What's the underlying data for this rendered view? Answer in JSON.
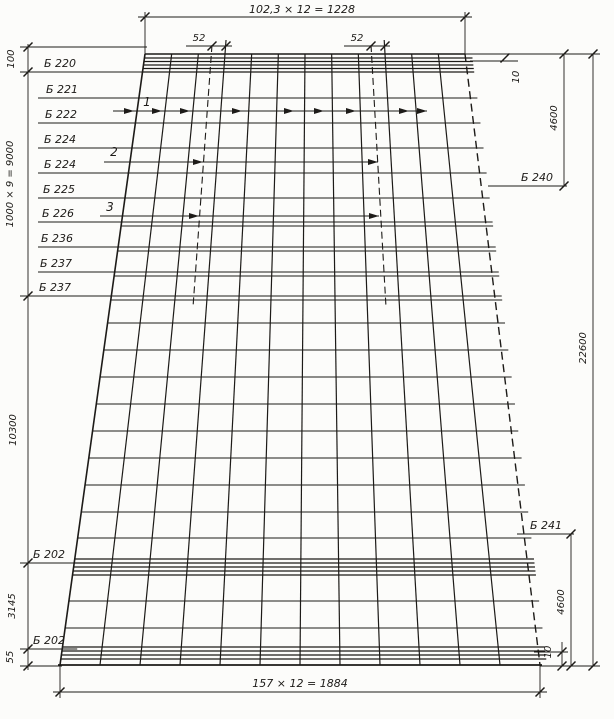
{
  "drawing": {
    "colors": {
      "ink": "#1d1b18",
      "paper": "#fcfcfa"
    },
    "trapezoid": {
      "top_y": 54,
      "bottom_y": 665,
      "top_x1": 145,
      "top_x2": 465,
      "bottom_x1": 60,
      "bottom_x2": 540
    },
    "grid": {
      "vertical_count": 13,
      "top_dx": 26.6667,
      "bot_dx": 40,
      "tall_tops": [
        3,
        9
      ],
      "tall_top_y": 40,
      "rows_single": [
        98,
        123,
        148,
        173,
        198,
        323,
        350,
        377,
        404,
        431,
        458,
        485,
        512,
        538,
        601,
        628
      ],
      "rows_double": [
        222,
        247,
        272,
        296
      ],
      "double_gap": 4,
      "bands": [
        [
          58,
          61.5,
          65,
          68.5,
          72
        ],
        [
          559,
          563,
          567,
          571,
          575
        ],
        [
          647,
          651,
          655,
          659
        ]
      ],
      "right_overhang": 7
    },
    "dashed_lines": [
      {
        "x1": 212,
        "y1": 45,
        "x2": 193,
        "y2": 307
      },
      {
        "x1": 371,
        "y1": 45,
        "x2": 386,
        "y2": 307
      }
    ],
    "arrow_callouts": [
      {
        "label": "1",
        "lx": 147,
        "ly": 106,
        "y": 111,
        "x1": 113,
        "x2": 427,
        "tips": [
          134,
          162,
          190,
          242,
          294,
          324,
          356,
          409,
          427
        ]
      },
      {
        "label": "2",
        "lx": 114,
        "ly": 156,
        "y": 162,
        "x1": 104,
        "x2": 378,
        "tips": [
          203,
          378
        ]
      },
      {
        "label": "3",
        "lx": 110,
        "ly": 211,
        "y": 216,
        "x1": 100,
        "x2": 379,
        "tips": [
          199,
          379
        ]
      }
    ],
    "beam_labels_left": [
      {
        "text": "Б 220",
        "tx": 44,
        "ty": 67,
        "leader_y": 72
      },
      {
        "text": "Б 221",
        "tx": 46,
        "ty": 93,
        "leader_y": 98
      },
      {
        "text": "Б 222",
        "tx": 45,
        "ty": 118,
        "leader_y": 123
      },
      {
        "text": "Б 224",
        "tx": 44,
        "ty": 143,
        "leader_y": 148
      },
      {
        "text": "Б 224",
        "tx": 44,
        "ty": 168,
        "leader_y": 173
      },
      {
        "text": "Б 225",
        "tx": 43,
        "ty": 193,
        "leader_y": 198
      },
      {
        "text": "Б 226",
        "tx": 42,
        "ty": 217,
        "leader_y": 222
      },
      {
        "text": "Б 236",
        "tx": 41,
        "ty": 242,
        "leader_y": 247
      },
      {
        "text": "Б 237",
        "tx": 40,
        "ty": 267,
        "leader_y": 272
      },
      {
        "text": "Б 237",
        "tx": 39,
        "ty": 291,
        "leader_y": 296
      },
      {
        "text": "Б 202",
        "tx": 33,
        "ty": 558,
        "leader_y": 563
      },
      {
        "text": "Б 202",
        "tx": 33,
        "ty": 644,
        "leader_y": 649
      }
    ],
    "beam_labels_right": [
      {
        "text": "Б 240",
        "x": 537,
        "y": 181,
        "leader": [
          488,
          186,
          567,
          186
        ],
        "tick": [
          564,
          186
        ]
      },
      {
        "text": "Б 241",
        "x": 546,
        "y": 529,
        "leader": [
          517,
          534,
          574,
          534
        ],
        "tick": [
          571,
          534
        ]
      }
    ],
    "dim_lines": [
      {
        "x1": 138,
        "y1": 17,
        "x2": 472,
        "y2": 17
      },
      {
        "x1": 145,
        "y1": 12,
        "x2": 145,
        "y2": 54
      },
      {
        "x1": 465,
        "y1": 12,
        "x2": 465,
        "y2": 54
      },
      {
        "x1": 186,
        "y1": 46,
        "x2": 232,
        "y2": 46
      },
      {
        "x1": 344,
        "y1": 46,
        "x2": 390,
        "y2": 46
      },
      {
        "x1": 28,
        "y1": 44,
        "x2": 28,
        "y2": 670
      },
      {
        "x1": 20,
        "y1": 47,
        "x2": 147,
        "y2": 47
      },
      {
        "x1": 20,
        "y1": 72,
        "x2": 44,
        "y2": 72
      },
      {
        "x1": 20,
        "y1": 296,
        "x2": 44,
        "y2": 296
      },
      {
        "x1": 20,
        "y1": 563,
        "x2": 44,
        "y2": 563
      },
      {
        "x1": 20,
        "y1": 649,
        "x2": 44,
        "y2": 649
      },
      {
        "x1": 20,
        "y1": 666,
        "x2": 62,
        "y2": 666
      },
      {
        "x1": 465,
        "y1": 54,
        "x2": 600,
        "y2": 54
      },
      {
        "x1": 470,
        "y1": 61,
        "x2": 518,
        "y2": 61
      },
      {
        "x1": 564,
        "y1": 54,
        "x2": 564,
        "y2": 186
      },
      {
        "x1": 593,
        "y1": 54,
        "x2": 593,
        "y2": 666
      },
      {
        "x1": 571,
        "y1": 534,
        "x2": 571,
        "y2": 666
      },
      {
        "x1": 534,
        "y1": 652,
        "x2": 568,
        "y2": 652
      },
      {
        "x1": 562,
        "y1": 642,
        "x2": 562,
        "y2": 666
      },
      {
        "x1": 540,
        "y1": 666,
        "x2": 600,
        "y2": 666
      },
      {
        "x1": 53,
        "y1": 692,
        "x2": 547,
        "y2": 692
      },
      {
        "x1": 60,
        "y1": 665,
        "x2": 60,
        "y2": 698
      },
      {
        "x1": 540,
        "y1": 665,
        "x2": 540,
        "y2": 698
      }
    ],
    "ticks": [
      [
        145,
        17
      ],
      [
        465,
        17
      ],
      [
        212,
        46
      ],
      [
        226,
        46
      ],
      [
        371,
        46
      ],
      [
        385,
        46
      ],
      [
        28,
        47
      ],
      [
        28,
        72
      ],
      [
        28,
        296
      ],
      [
        28,
        563
      ],
      [
        28,
        649
      ],
      [
        28,
        666
      ],
      [
        505,
        58
      ],
      [
        564,
        54
      ],
      [
        593,
        54
      ],
      [
        562,
        652
      ],
      [
        562,
        666
      ],
      [
        571,
        666
      ],
      [
        593,
        666
      ],
      [
        60,
        692
      ],
      [
        540,
        692
      ]
    ],
    "dim_texts": [
      {
        "t": "102,3 × 12 = 1228",
        "x": 302,
        "y": 13,
        "s": 11
      },
      {
        "t": "52",
        "x": 199,
        "y": 41,
        "s": 10
      },
      {
        "t": "52",
        "x": 357,
        "y": 41,
        "s": 10
      },
      {
        "t": "100",
        "x": 14,
        "y": 59,
        "r": -90,
        "s": 10
      },
      {
        "t": "1000 × 9 = 9000",
        "x": 13,
        "y": 184,
        "r": -90,
        "s": 10
      },
      {
        "t": "10300",
        "x": 16,
        "y": 430,
        "r": -90,
        "s": 10
      },
      {
        "t": "3145",
        "x": 15,
        "y": 606,
        "r": -90,
        "s": 10
      },
      {
        "t": "55",
        "x": 13,
        "y": 657,
        "r": -90,
        "s": 10
      },
      {
        "t": "10",
        "x": 519,
        "y": 77,
        "r": -90,
        "s": 10
      },
      {
        "t": "4600",
        "x": 557,
        "y": 118,
        "r": -90,
        "s": 10
      },
      {
        "t": "22600",
        "x": 586,
        "y": 348,
        "r": -90,
        "s": 10
      },
      {
        "t": "4600",
        "x": 564,
        "y": 602,
        "r": -90,
        "s": 10
      },
      {
        "t": "10",
        "x": 551,
        "y": 652,
        "r": -90,
        "s": 10
      },
      {
        "t": "157 × 12 = 1884",
        "x": 300,
        "y": 687,
        "s": 11
      }
    ]
  }
}
